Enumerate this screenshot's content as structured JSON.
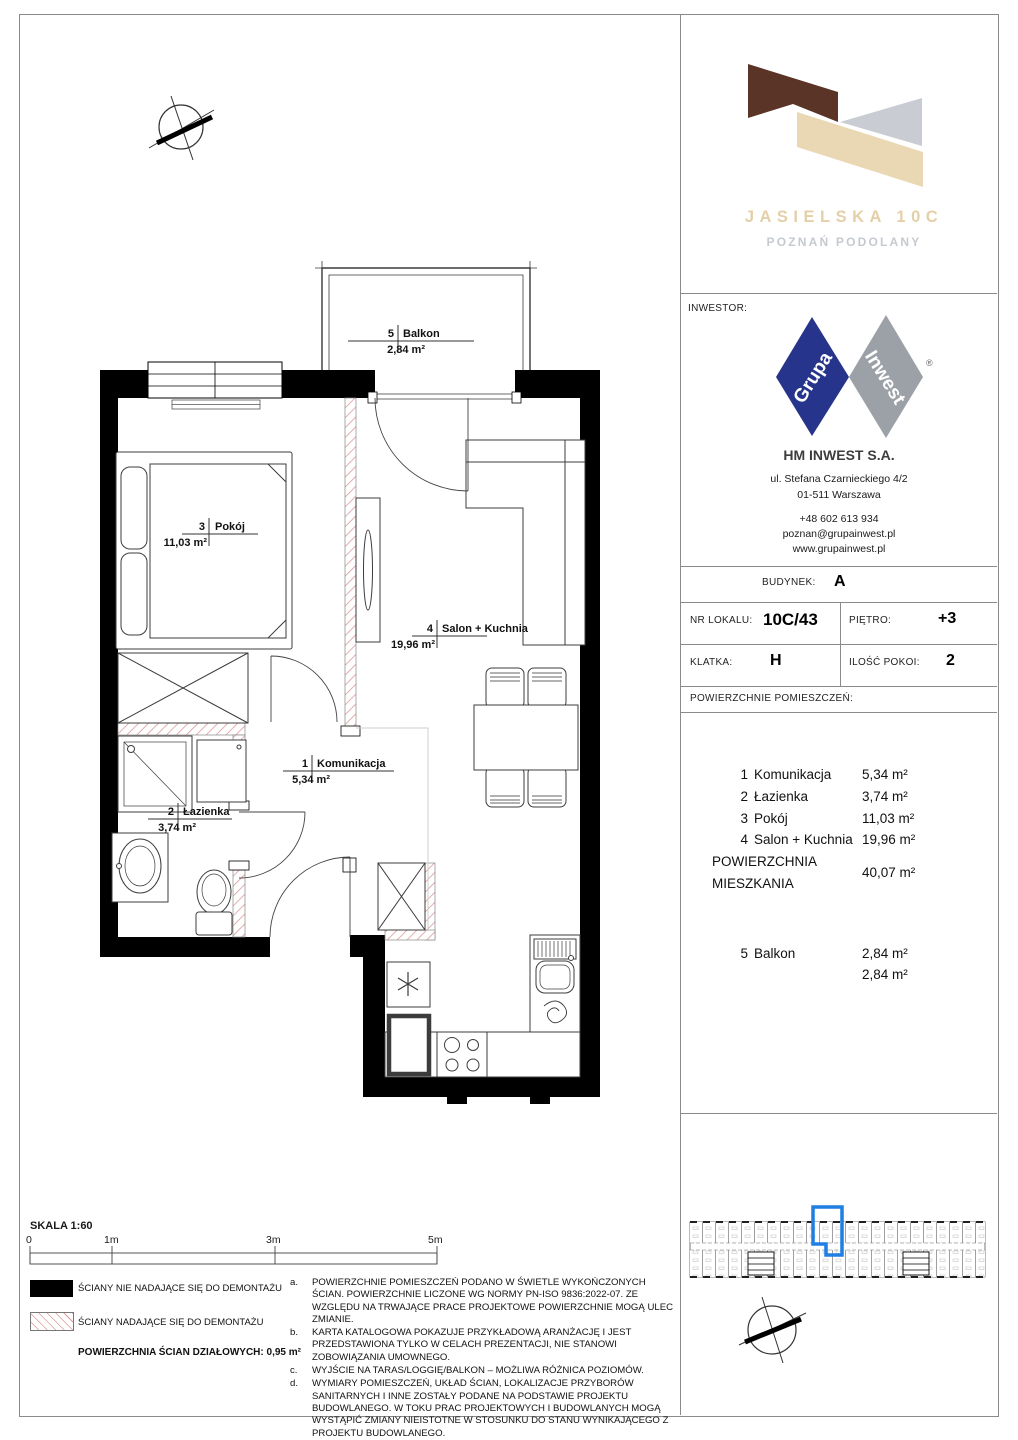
{
  "header": {
    "title": "JASIELSKA 10C",
    "subtitle": "POZNAŃ PODOLANY"
  },
  "investor": {
    "section_label": "INWESTOR:",
    "logo_word1": "Grupa",
    "logo_word2": "Inwest",
    "trademark": "®",
    "company": "HM INWEST S.A.",
    "address1": "ul. Stefana Czarnieckiego 4/2",
    "address2": "01-511 Warszawa",
    "phone": "+48 602 613 934",
    "email": "poznan@grupainwest.pl",
    "website": "www.grupainwest.pl"
  },
  "unit": {
    "building_label": "BUDYNEK:",
    "building": "A",
    "number_label": "NR LOKALU:",
    "number": "10C/43",
    "floor_label": "PIĘTRO:",
    "floor": "+3",
    "staircase_label": "KLATKA:",
    "staircase": "H",
    "rooms_count_label": "ILOŚĆ POKOI:",
    "rooms_count": "2",
    "areas_label": "POWIERZCHNIE POMIESZCZEŃ:"
  },
  "rooms": [
    {
      "no": "1",
      "name": "Komunikacja",
      "area": "5,34 m²"
    },
    {
      "no": "2",
      "name": "Łazienka",
      "area": "3,74 m²"
    },
    {
      "no": "3",
      "name": "Pokój",
      "area": "11,03 m²"
    },
    {
      "no": "4",
      "name": "Salon + Kuchnia",
      "area": "19,96 m²"
    }
  ],
  "total": {
    "label_line1": "POWIERZCHNIA",
    "label_line2": "MIESZKANIA",
    "area": "40,07 m²"
  },
  "balcony": {
    "no": "5",
    "name": "Balkon",
    "area": "2,84 m²",
    "total": "2,84 m²"
  },
  "plan": {
    "komunikacja": {
      "no": "1",
      "name": "Komunikacja",
      "area": "5,34 m²"
    },
    "lazienka": {
      "no": "2",
      "name": "Łazienka",
      "area": "3,74 m²"
    },
    "pokoj": {
      "no": "3",
      "name": "Pokój",
      "area": "11,03 m²"
    },
    "salon": {
      "no": "4",
      "name": "Salon + Kuchnia",
      "area": "19,96 m²"
    },
    "balkon": {
      "no": "5",
      "name": "Balkon",
      "area": "2,84 m²"
    }
  },
  "scalebar": {
    "title": "SKALA 1:60",
    "ticks": [
      "0",
      "1m",
      "3m",
      "5m"
    ]
  },
  "legend": {
    "solid_label": "ŚCIANY NIE NADAJĄCE SIĘ DO DEMONTAŻU",
    "hatched_label": "ŚCIANY NADAJĄCE SIĘ DO DEMONTAŻU",
    "partition_area": "POWIERZCHNIA ŚCIAN DZIAŁOWYCH: 0,95 m²"
  },
  "notes": [
    {
      "id": "a.",
      "text": "POWIERZCHNIE POMIESZCZEŃ PODANO W ŚWIETLE WYKOŃCZONYCH ŚCIAN. POWIERZCHNIE LICZONE WG NORMY PN-ISO 9836:2022-07. ZE WZGLĘDU NA TRWAJĄCE PRACE PROJEKTOWE POWIERZCHNIE MOGĄ ULEC ZMIANIE."
    },
    {
      "id": "b.",
      "text": "KARTA KATALOGOWA POKAZUJE PRZYKŁADOWĄ ARANŻACJĘ I JEST PRZEDSTAWIONA TYLKO W CELACH PREZENTACJI, NIE STANOWI ZOBOWIĄZANIA UMOWNEGO."
    },
    {
      "id": "c.",
      "text": "WYJŚCIE NA TARAS/LOGGIĘ/BALKON – MOŻLIWA RÓŻNICA POZIOMÓW."
    },
    {
      "id": "d.",
      "text": "WYMIARY POMIESZCZEŃ, UKŁAD ŚCIAN, LOKALIZACJE PRZYBORÓW SANITARNYCH I INNE ZOSTAŁY PODANE NA PODSTAWIE PROJEKTU BUDOWLANEGO. W TOKU PRAC PROJEKTOWYCH I BUDOWLANYCH MOGĄ WYSTĄPIĆ ZMIANY NIEISTOTNE W STOSUNKU DO STANU WYNIKAJĄCEGO Z PROJEKTU BUDOWLANEGO."
    }
  ],
  "colors": {
    "highlight_blue": "#1f7fe3",
    "logo_brown": "#5b3428",
    "logo_beige": "#ead8b4",
    "logo_gray": "#c9cdd3",
    "logo_title_text": "#e4d0a8",
    "logo_subtitle_text": "#c5cad0",
    "brand_navy": "#27348b",
    "brand_gray": "#9ca1a7",
    "hatch_red": "#dd9a9a",
    "wall_black": "#000000"
  }
}
